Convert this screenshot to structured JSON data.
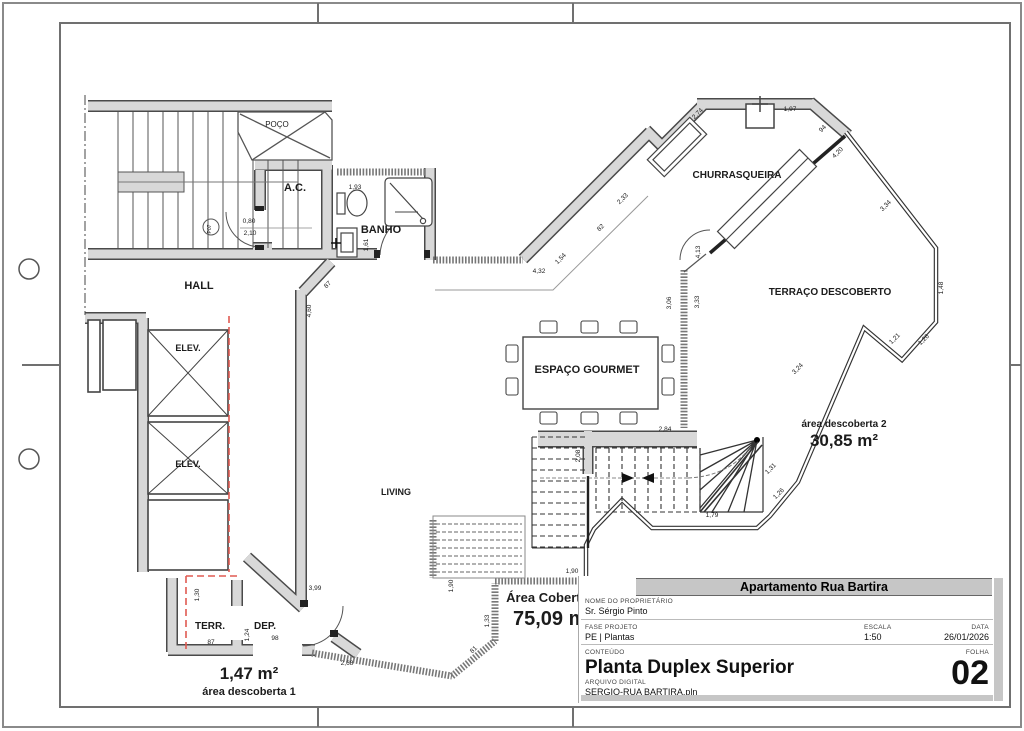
{
  "sheet": {
    "header_title": "Apartamento Rua Bartira",
    "owner_label": "NOME DO PROPRIETÁRIO",
    "owner": "Sr. Sérgio Pinto",
    "phase_label": "FASE PROJETO",
    "phase": "PE | Plantas",
    "scale_label": "ESCALA",
    "scale": "1:50",
    "date_label": "DATA",
    "date": "26/01/2026",
    "content_label": "CONTEÚDO",
    "content": "Planta Duplex Superior",
    "file_label": "ARQUIVO DIGITAL",
    "file": "SERGIO-RUA BARTIRA.pln",
    "folha_label": "FOLHA",
    "folha": "02"
  },
  "plan": {
    "door_tag": "P07",
    "rooms": [
      {
        "t": "POÇO",
        "x": 277,
        "y": 127,
        "s": 8,
        "b": 0
      },
      {
        "t": "A.C.",
        "x": 295,
        "y": 191,
        "s": 11,
        "b": 1
      },
      {
        "t": "BANHO",
        "x": 381,
        "y": 233,
        "s": 11,
        "b": 1
      },
      {
        "t": "HALL",
        "x": 199,
        "y": 289,
        "s": 11,
        "b": 1
      },
      {
        "t": "ELEV.",
        "x": 188,
        "y": 351,
        "s": 9,
        "b": 1
      },
      {
        "t": "ELEV.",
        "x": 188,
        "y": 467,
        "s": 9,
        "b": 1
      },
      {
        "t": "LIVING",
        "x": 396,
        "y": 495,
        "s": 9,
        "b": 1
      },
      {
        "t": "ESPAÇO GOURMET",
        "x": 587,
        "y": 373,
        "s": 11,
        "b": 1
      },
      {
        "t": "CHURRASQUEIRA",
        "x": 737,
        "y": 178,
        "s": 10,
        "b": 1
      },
      {
        "t": "TERRAÇO DESCOBERTO",
        "x": 830,
        "y": 295,
        "s": 10,
        "b": 1
      },
      {
        "t": "TERR.",
        "x": 210,
        "y": 629,
        "s": 10,
        "b": 1
      },
      {
        "t": "DEP.",
        "x": 265,
        "y": 629,
        "s": 10,
        "b": 1
      }
    ],
    "areas": [
      {
        "t": "área descoberta 2",
        "x": 844,
        "y": 427,
        "s": 10
      },
      {
        "t": "30,85 m²",
        "x": 844,
        "y": 446,
        "s": 17
      },
      {
        "t": "Área Coberta",
        "x": 547,
        "y": 602,
        "s": 13
      },
      {
        "t": "75,09 m²",
        "x": 553,
        "y": 625,
        "s": 20
      },
      {
        "t": "1,47 m²",
        "x": 249,
        "y": 679,
        "s": 17
      },
      {
        "t": "área descoberta 1",
        "x": 249,
        "y": 695,
        "s": 11
      }
    ],
    "dimensions": [
      {
        "t": "1,93",
        "x": 355,
        "y": 189
      },
      {
        "t": "1,61",
        "x": 368,
        "y": 245,
        "r": -90
      },
      {
        "t": "0,80",
        "x": 249,
        "y": 223
      },
      {
        "t": "2,10",
        "x": 250,
        "y": 235
      },
      {
        "t": "87",
        "x": 329,
        "y": 286,
        "r": -45
      },
      {
        "t": "4,60",
        "x": 311,
        "y": 311,
        "r": -90
      },
      {
        "t": "4,32",
        "x": 539,
        "y": 273
      },
      {
        "t": "1,54",
        "x": 562,
        "y": 260,
        "r": -45
      },
      {
        "t": "82",
        "x": 602,
        "y": 229,
        "r": -45
      },
      {
        "t": "2,33",
        "x": 624,
        "y": 200,
        "r": -45
      },
      {
        "t": "2,74",
        "x": 699,
        "y": 115,
        "r": -45
      },
      {
        "t": "1,97",
        "x": 790,
        "y": 111
      },
      {
        "t": "94",
        "x": 824,
        "y": 130,
        "r": -45
      },
      {
        "t": "4,20",
        "x": 839,
        "y": 154,
        "r": -45
      },
      {
        "t": "3,34",
        "x": 887,
        "y": 207,
        "r": -45
      },
      {
        "t": "1,48",
        "x": 943,
        "y": 288,
        "r": -90
      },
      {
        "t": "1,21",
        "x": 896,
        "y": 340,
        "r": -45
      },
      {
        "t": "1,26",
        "x": 925,
        "y": 341,
        "r": -45
      },
      {
        "t": "3,24",
        "x": 799,
        "y": 370,
        "r": -45
      },
      {
        "t": "4,13",
        "x": 700,
        "y": 252,
        "r": -90
      },
      {
        "t": "3,06",
        "x": 671,
        "y": 303,
        "r": -90
      },
      {
        "t": "3,33",
        "x": 699,
        "y": 302,
        "r": -90
      },
      {
        "t": "2,84",
        "x": 665,
        "y": 431
      },
      {
        "t": "2,08",
        "x": 580,
        "y": 456,
        "r": -90
      },
      {
        "t": "1,79",
        "x": 712,
        "y": 517
      },
      {
        "t": "1,31",
        "x": 772,
        "y": 470,
        "r": -45
      },
      {
        "t": "1,26",
        "x": 780,
        "y": 495,
        "r": -45
      },
      {
        "t": "1,90",
        "x": 572,
        "y": 573
      },
      {
        "t": "1,90",
        "x": 453,
        "y": 586,
        "r": -90
      },
      {
        "t": "1,33",
        "x": 489,
        "y": 621,
        "r": -90
      },
      {
        "t": "81",
        "x": 475,
        "y": 651,
        "r": -45
      },
      {
        "t": "2,68",
        "x": 347,
        "y": 665
      },
      {
        "t": "3,99",
        "x": 315,
        "y": 590
      },
      {
        "t": "1,30",
        "x": 199,
        "y": 595,
        "r": -90
      },
      {
        "t": "87",
        "x": 211,
        "y": 644
      },
      {
        "t": "1,24",
        "x": 249,
        "y": 635,
        "r": -90
      },
      {
        "t": "98",
        "x": 275,
        "y": 640
      }
    ],
    "colors": {
      "wall_fill": "#d8d8d8",
      "wall_edge": "#4a4a4a",
      "red_dashed": "#e05a52",
      "title_bar": "#c6c6c6"
    }
  }
}
